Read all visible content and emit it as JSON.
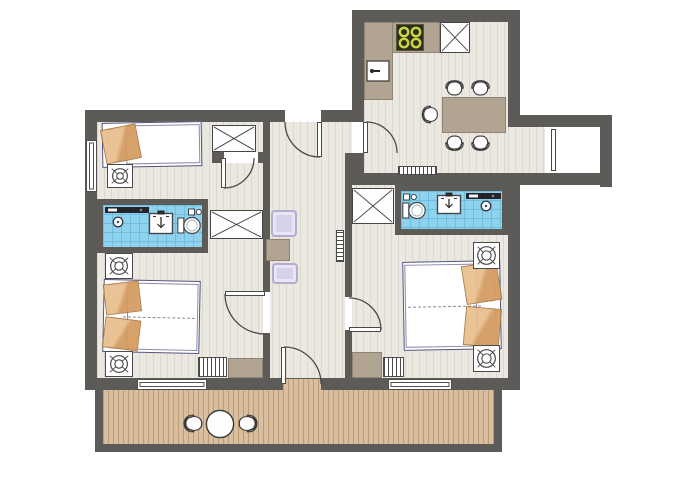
{
  "palette": {
    "wall": "#5c5b57",
    "floorBase": "#ebe8e1",
    "floorLine": "#dcd8cd",
    "deckBase": "#d9bf9f",
    "deckLine": "#bb9c76",
    "tile": "#8fd2ee",
    "tileLine": "#6ebfdf",
    "counter": "#b2a492",
    "counterLine": "#8f8373",
    "bedOutline": "#54547e",
    "blanket1": "#e9c191",
    "blanket2": "#d59c63",
    "blanketLine": "#ad7a42",
    "rug": "#d6d2ea",
    "rugLine": "#b3accf",
    "burner": "#cbd740",
    "stoveBg": "#2e2e1d",
    "outline": "#4a4a4a"
  },
  "plan": {
    "elements": [
      {
        "t": "floor",
        "n": "floor-main",
        "x": 97,
        "y": 122,
        "w": 411,
        "h": 256
      },
      {
        "t": "floor",
        "n": "floor-kitchen",
        "x": 364,
        "y": 22,
        "w": 144,
        "h": 151
      },
      {
        "t": "floor",
        "n": "floor-corridor",
        "x": 508,
        "y": 127,
        "w": 37,
        "h": 46
      },
      {
        "t": "deck",
        "n": "terrace-deck",
        "x": 103,
        "y": 390,
        "w": 391,
        "h": 54
      },
      {
        "t": "wall",
        "n": "terrace-frame-left",
        "x": 95,
        "y": 390,
        "w": 8,
        "h": 62
      },
      {
        "t": "wall",
        "n": "terrace-frame-bottom",
        "x": 95,
        "y": 444,
        "w": 407,
        "h": 8
      },
      {
        "t": "wall",
        "n": "terrace-frame-right",
        "x": 494,
        "y": 390,
        "w": 8,
        "h": 62
      },
      {
        "t": "wall",
        "n": "wall-left-main",
        "x": 85,
        "y": 110,
        "w": 12,
        "h": 280
      },
      {
        "t": "wall",
        "n": "wall-top-main",
        "x": 85,
        "y": 110,
        "w": 279,
        "h": 12
      },
      {
        "t": "wall",
        "n": "wall-kitchen-left",
        "x": 352,
        "y": 10,
        "w": 12,
        "h": 112
      },
      {
        "t": "wall",
        "n": "wall-kitchen-top",
        "x": 352,
        "y": 10,
        "w": 168,
        "h": 12
      },
      {
        "t": "wall",
        "n": "wall-kitchen-right",
        "x": 508,
        "y": 10,
        "w": 12,
        "h": 117
      },
      {
        "t": "wall",
        "n": "wall-corridor-top",
        "x": 508,
        "y": 115,
        "w": 104,
        "h": 12
      },
      {
        "t": "wall",
        "n": "wall-corridor-right",
        "x": 600,
        "y": 115,
        "w": 12,
        "h": 72
      },
      {
        "t": "wall",
        "n": "wall-corridor-bottom",
        "x": 508,
        "y": 173,
        "w": 104,
        "h": 12
      },
      {
        "t": "wall",
        "n": "wall-right-main",
        "x": 508,
        "y": 173,
        "w": 12,
        "h": 217
      },
      {
        "t": "wall",
        "n": "wall-bottom-main",
        "x": 85,
        "y": 378,
        "w": 435,
        "h": 12
      },
      {
        "t": "wall",
        "n": "wall-hall-left-upper",
        "x": 263,
        "y": 122,
        "w": 7,
        "h": 170
      },
      {
        "t": "wall",
        "n": "wall-hall-left-lower",
        "x": 263,
        "y": 333,
        "w": 7,
        "h": 45
      },
      {
        "t": "wall",
        "n": "wall-bedroom1-stub-left",
        "x": 212,
        "y": 152,
        "w": 12,
        "h": 11
      },
      {
        "t": "wall",
        "n": "wall-bedroom1-stub-right",
        "x": 258,
        "y": 152,
        "w": 8,
        "h": 11
      },
      {
        "t": "wall",
        "n": "wall-hall-right-upper",
        "x": 345,
        "y": 153,
        "w": 7,
        "h": 144
      },
      {
        "t": "wall",
        "n": "wall-hall-right-lower",
        "x": 345,
        "y": 330,
        "w": 7,
        "h": 48
      },
      {
        "t": "wall",
        "n": "wall-kitchen-hall-corner",
        "x": 345,
        "y": 153,
        "w": 19,
        "h": 20
      },
      {
        "t": "wall",
        "n": "wall-bathroom-right-top",
        "x": 345,
        "y": 173,
        "w": 163,
        "h": 12
      },
      {
        "t": "window",
        "n": "window-bedroom1-left",
        "x": 86,
        "y": 140,
        "w": 11,
        "h": 52
      },
      {
        "t": "window",
        "n": "window-bedroom2-bottom",
        "x": 137,
        "y": 379,
        "w": 70,
        "h": 11
      },
      {
        "t": "window",
        "n": "window-bedroom3-bottom",
        "x": 388,
        "y": 379,
        "w": 64,
        "h": 11
      },
      {
        "t": "gap",
        "n": "doorway-hall-top",
        "x": 285,
        "y": 110,
        "w": 36,
        "h": 12
      },
      {
        "t": "gap",
        "n": "doorway-kitchen",
        "x": 352,
        "y": 122,
        "w": 12,
        "h": 31
      },
      {
        "t": "gap",
        "n": "doorway-bedroom1",
        "x": 224,
        "y": 152,
        "w": 34,
        "h": 11
      },
      {
        "t": "gap",
        "n": "doorway-bedroom2",
        "x": 263,
        "y": 292,
        "w": 7,
        "h": 41
      },
      {
        "t": "gap",
        "n": "doorway-bedroom3",
        "x": 345,
        "y": 297,
        "w": 7,
        "h": 33
      },
      {
        "t": "deck",
        "n": "terrace-door-threshold",
        "x": 283,
        "y": 379,
        "w": 38,
        "h": 11
      },
      {
        "t": "gap",
        "n": "entry-opening",
        "x": 545,
        "y": 127,
        "w": 55,
        "h": 46
      },
      {
        "t": "bath",
        "n": "bathroom-left",
        "x": 97,
        "y": 199,
        "w": 111,
        "h": 54
      },
      {
        "t": "bath",
        "n": "bathroom-right",
        "x": 395,
        "y": 185,
        "w": 113,
        "h": 50
      },
      {
        "t": "xbox",
        "n": "wardrobe-bedroom1",
        "x": 212,
        "y": 125,
        "w": 44,
        "h": 27
      },
      {
        "t": "xbox",
        "n": "wardrobe-hall-left",
        "x": 210,
        "y": 210,
        "w": 53,
        "h": 29
      },
      {
        "t": "xbox",
        "n": "wardrobe-hall-right",
        "x": 352,
        "y": 188,
        "w": 42,
        "h": 36
      },
      {
        "t": "xbox",
        "n": "fridge-unit",
        "x": 440,
        "y": 22,
        "w": 30,
        "h": 31
      },
      {
        "t": "counter",
        "n": "kitchen-counter-top",
        "x": 364,
        "y": 22,
        "w": 76,
        "h": 31
      },
      {
        "t": "counter",
        "n": "kitchen-counter-left",
        "x": 364,
        "y": 22,
        "w": 29,
        "h": 78
      },
      {
        "t": "stove",
        "n": "stove",
        "x": 396,
        "y": 24,
        "w": 28,
        "h": 27
      },
      {
        "t": "sink",
        "n": "kitchen-sink",
        "x": 366,
        "y": 60,
        "w": 24,
        "h": 22
      },
      {
        "t": "counter",
        "n": "dining-table",
        "x": 442,
        "y": 97,
        "w": 64,
        "h": 36
      },
      {
        "t": "chair",
        "n": "dining-chair-1",
        "x": 443,
        "y": 76,
        "w": 23,
        "h": 22,
        "face": "up"
      },
      {
        "t": "chair",
        "n": "dining-chair-2",
        "x": 469,
        "y": 76,
        "w": 23,
        "h": 22,
        "face": "up"
      },
      {
        "t": "chair",
        "n": "dining-chair-3",
        "x": 443,
        "y": 133,
        "w": 23,
        "h": 22,
        "face": "down"
      },
      {
        "t": "chair",
        "n": "dining-chair-4",
        "x": 469,
        "y": 133,
        "w": 23,
        "h": 22,
        "face": "down"
      },
      {
        "t": "chair",
        "n": "dining-chair-5",
        "x": 418,
        "y": 103,
        "w": 22,
        "h": 23,
        "face": "left"
      },
      {
        "t": "bed",
        "n": "bed-bedroom1",
        "x": 102,
        "y": 122,
        "w": 100,
        "h": 45,
        "head": "left",
        "double": false,
        "rot": -1
      },
      {
        "t": "bed",
        "n": "bed-bedroom2",
        "x": 103,
        "y": 280,
        "w": 97,
        "h": 73,
        "head": "left",
        "double": true,
        "rot": 1.2
      },
      {
        "t": "bed",
        "n": "bed-bedroom3",
        "x": 403,
        "y": 261,
        "w": 98,
        "h": 89,
        "head": "right",
        "double": true,
        "rot": -1
      },
      {
        "t": "plant",
        "n": "plant-table-bedroom1",
        "x": 107,
        "y": 164,
        "w": 26,
        "h": 24
      },
      {
        "t": "plant",
        "n": "plant-table-bedroom2-top",
        "x": 105,
        "y": 253,
        "w": 28,
        "h": 26
      },
      {
        "t": "plant",
        "n": "plant-table-bedroom2-bottom",
        "x": 105,
        "y": 351,
        "w": 28,
        "h": 26
      },
      {
        "t": "plant",
        "n": "plant-table-bedroom3-top",
        "x": 473,
        "y": 242,
        "w": 27,
        "h": 27
      },
      {
        "t": "plant",
        "n": "plant-table-bedroom3-bottom",
        "x": 473,
        "y": 345,
        "w": 27,
        "h": 27
      },
      {
        "t": "counter",
        "n": "desk-bedroom2",
        "x": 228,
        "y": 358,
        "w": 35,
        "h": 20
      },
      {
        "t": "counter",
        "n": "desk-bedroom3",
        "x": 352,
        "y": 352,
        "w": 30,
        "h": 26
      },
      {
        "t": "radiator",
        "n": "radiator-bedroom2",
        "x": 198,
        "y": 357,
        "w": 29,
        "h": 20,
        "dir": "v"
      },
      {
        "t": "radiator",
        "n": "radiator-bedroom3",
        "x": 383,
        "y": 357,
        "w": 21,
        "h": 20,
        "dir": "v"
      },
      {
        "t": "radiator",
        "n": "radiator-hall",
        "x": 336,
        "y": 230,
        "w": 8,
        "h": 32,
        "dir": "h"
      },
      {
        "t": "radiator",
        "n": "radiator-corridor",
        "x": 398,
        "y": 166,
        "w": 39,
        "h": 9,
        "dir": "v"
      },
      {
        "t": "vanity",
        "n": "vanity-bathroom-left",
        "x": 105,
        "y": 207,
        "w": 44,
        "h": 22,
        "cx": 13
      },
      {
        "t": "basin",
        "n": "washbasin-bathroom-left",
        "x": 148,
        "y": 210,
        "w": 26,
        "h": 25
      },
      {
        "t": "toilet",
        "n": "toilet-bathroom-left",
        "x": 177,
        "y": 215,
        "w": 24,
        "h": 21
      },
      {
        "t": "acc",
        "n": "accessory-bathroom-left",
        "x": 188,
        "y": 208,
        "w": 14,
        "h": 8
      },
      {
        "t": "toilet",
        "n": "toilet-bathroom-right",
        "x": 402,
        "y": 200,
        "w": 24,
        "h": 21
      },
      {
        "t": "acc",
        "n": "accessory-bathroom-right",
        "x": 403,
        "y": 193,
        "w": 14,
        "h": 8
      },
      {
        "t": "basin",
        "n": "washbasin-bathroom-right",
        "x": 436,
        "y": 192,
        "w": 26,
        "h": 23
      },
      {
        "t": "vanity",
        "n": "vanity-bathroom-right",
        "x": 466,
        "y": 193,
        "w": 35,
        "h": 20,
        "cx": 20
      },
      {
        "t": "rug",
        "n": "hall-rug-upper",
        "x": 271,
        "y": 210,
        "w": 26,
        "h": 27
      },
      {
        "t": "box",
        "n": "hall-cabinet",
        "x": 266,
        "y": 239,
        "w": 24,
        "h": 22
      },
      {
        "t": "rug",
        "n": "hall-rug-lower",
        "x": 272,
        "y": 263,
        "w": 26,
        "h": 21
      },
      {
        "t": "rtable",
        "n": "terrace-table",
        "x": 205,
        "y": 409,
        "w": 30,
        "h": 30
      },
      {
        "t": "chair",
        "n": "terrace-chair-left",
        "x": 181,
        "y": 410,
        "w": 22,
        "h": 27,
        "face": "left"
      },
      {
        "t": "chair",
        "n": "terrace-chair-right",
        "x": 238,
        "y": 410,
        "w": 22,
        "h": 27,
        "face": "right"
      },
      {
        "t": "leaf",
        "n": "door-leaf-hall-top",
        "x": 317,
        "y": 122,
        "w": 5,
        "h": 35
      },
      {
        "t": "leaf",
        "n": "door-leaf-kitchen",
        "x": 363,
        "y": 122,
        "w": 5,
        "h": 31
      },
      {
        "t": "leaf",
        "n": "door-leaf-bedroom1",
        "x": 221,
        "y": 158,
        "w": 5,
        "h": 30
      },
      {
        "t": "leaf",
        "n": "door-leaf-bedroom2",
        "x": 225,
        "y": 291,
        "w": 40,
        "h": 5
      },
      {
        "t": "leaf",
        "n": "door-leaf-bedroom3",
        "x": 349,
        "y": 327,
        "w": 32,
        "h": 5
      },
      {
        "t": "leaf",
        "n": "door-leaf-terrace",
        "x": 281,
        "y": 347,
        "w": 5,
        "h": 37
      },
      {
        "t": "leaf",
        "n": "entry-door-leaf",
        "x": 551,
        "y": 129,
        "w": 5,
        "h": 42
      }
    ],
    "door_arcs": [
      {
        "n": "door-arc-hall-top",
        "d": "M285,122 A35,35 0 0 0 320,157"
      },
      {
        "n": "door-arc-kitchen",
        "d": "M366,122 A31,31 0 0 1 397,153"
      },
      {
        "n": "door-arc-bedroom1",
        "d": "M224,188 A30,30 0 0 0 254,158"
      },
      {
        "n": "door-arc-bedroom2",
        "d": "M225,294 A40,40 0 0 0 265,334"
      },
      {
        "n": "door-arc-bedroom3",
        "d": "M349,298 A32,32 0 0 1 381,330"
      },
      {
        "n": "door-arc-terrace",
        "d": "M284,347 A37,37 0 0 1 321,384"
      }
    ]
  }
}
